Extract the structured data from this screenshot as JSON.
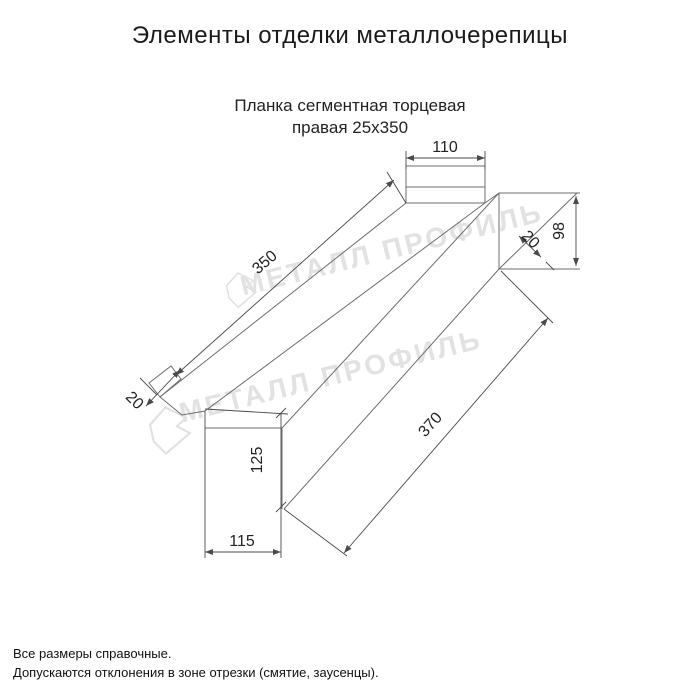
{
  "header": {
    "title": "Элементы отделки металлочерепицы"
  },
  "drawing": {
    "subtitle_line1": "Планка сегментная торцевая",
    "subtitle_line2": "правая 25x350",
    "watermark": {
      "text": "МЕТАЛЛ ПРОФИЛЬ"
    },
    "dimensions": {
      "top_width": "110",
      "upper_length": "350",
      "left_fold": "20",
      "end_height": "98",
      "right_fold": "20",
      "lower_length": "370",
      "end_face_height": "125",
      "bottom_width": "115"
    }
  },
  "footer": {
    "line1": "Все размеры справочные.",
    "line2": "Допускаются отклонения в зоне отрезки (смятие, заусенцы)."
  },
  "colors": {
    "line": "#6e6e6e",
    "dim": "#4a4a4a",
    "text": "#1b1b1b",
    "watermark": "#e2e2e2",
    "background": "#ffffff"
  }
}
